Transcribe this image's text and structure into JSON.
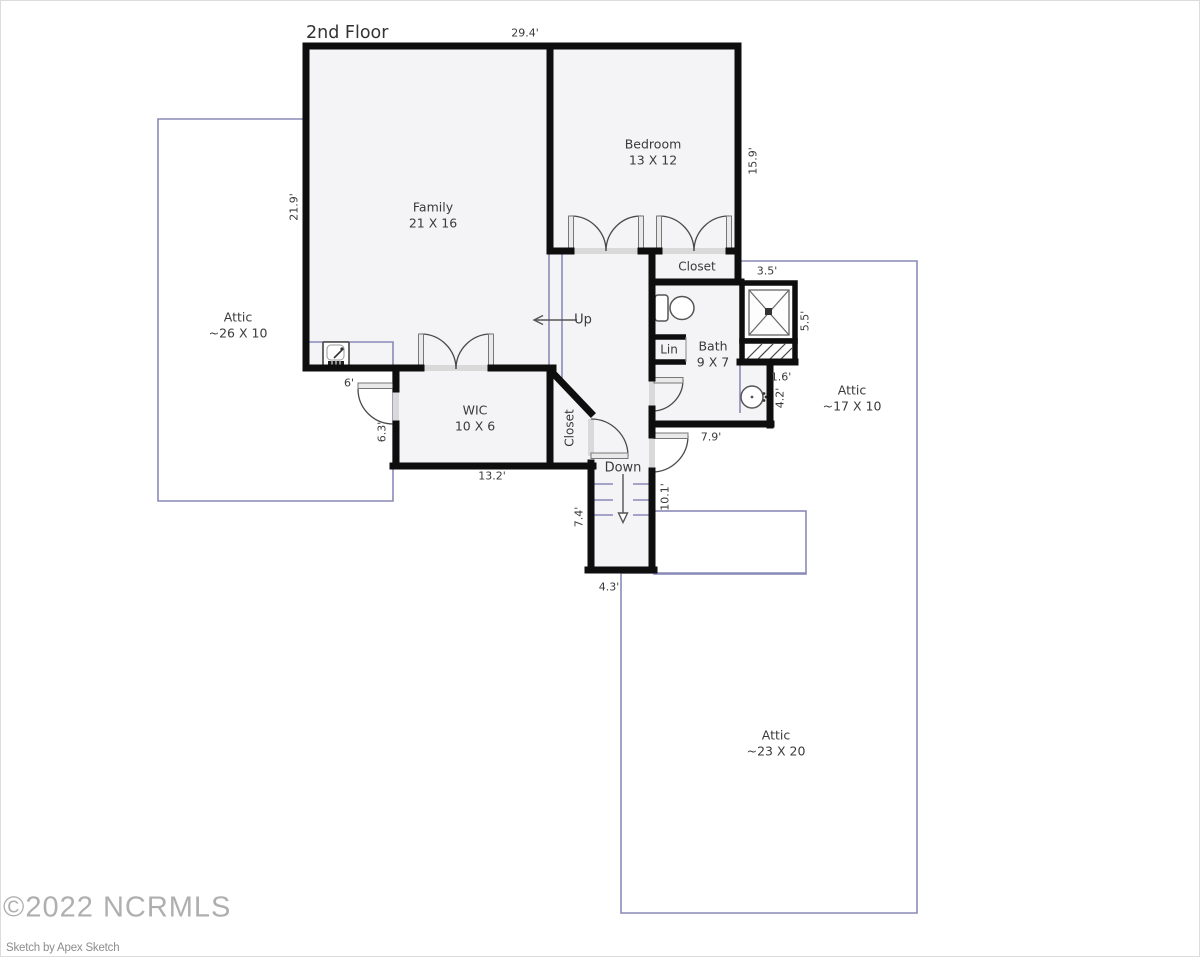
{
  "page": {
    "title": "2nd Floor"
  },
  "watermark": {
    "copyright": "©2022 NCRMLS",
    "credit": "Sketch by Apex Sketch"
  },
  "rooms": {
    "family": {
      "name": "Family",
      "size": "21 X 16"
    },
    "bedroom": {
      "name": "Bedroom",
      "size": "13 X 12"
    },
    "wic": {
      "name": "WIC",
      "size": "10 X 6"
    },
    "bath": {
      "name": "Bath",
      "size": "9 X 7"
    },
    "attic_left": {
      "name": "Attic",
      "size": "~26 X 10"
    },
    "attic_right": {
      "name": "Attic",
      "size": "~17 X 10"
    },
    "attic_bottom": {
      "name": "Attic",
      "size": "~23 X 20"
    },
    "bedroom_closet": {
      "name": "Closet"
    },
    "hall_closet": {
      "name": "Closet"
    },
    "linen_closet": {
      "name": "Lin"
    }
  },
  "stairs": {
    "up_label": "Up",
    "down_label": "Down"
  },
  "dimensions": {
    "overall_width": "29.4'",
    "family_height": "21.9'",
    "bedroom_height": "15.9'",
    "shower_width": "3.5'",
    "shower_height": "5.5'",
    "vanity_width": "1.6'",
    "vanity_height": "4.2'",
    "bath_width": "7.9'",
    "family_south_wall": "6'",
    "wic_height": "6.3'",
    "wic_width": "13.2'",
    "stair_height_left": "7.4'",
    "stair_height_right": "10.1'",
    "stair_width": "4.3'"
  },
  "colors": {
    "wall": "#0e0e0e",
    "attic_outline": "#8a8ab8",
    "room_fill": "#f4f4f6",
    "label_text": "#3a3a3a",
    "watermark": "#9c9c9c"
  }
}
